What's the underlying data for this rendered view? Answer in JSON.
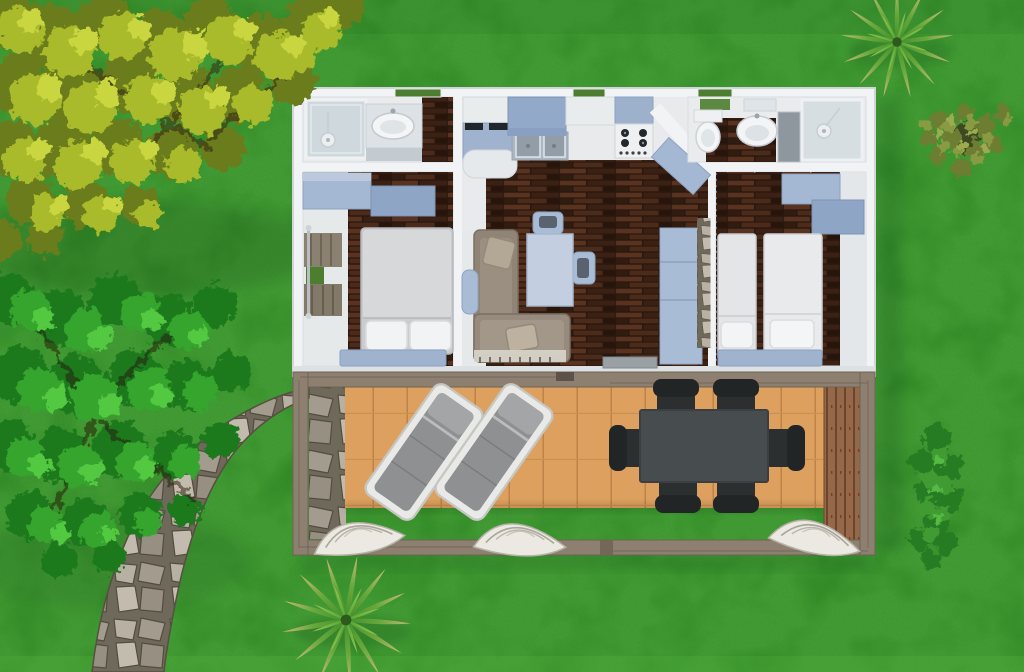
{
  "scene": {
    "description": "Aerial 3D rendering of a two-bedroom holiday mobile home floor plan with furnished interior, a wooden pergola terrace with two sun loungers and a six-seat dining set, set on a lawn with trees, palms, a hedge and a flagstone path",
    "rooms": [
      "left bathroom",
      "master bedroom",
      "kitchen and living room",
      "right bathroom",
      "twin bedroom",
      "terrace"
    ]
  },
  "colors": {
    "grass": "#419a33",
    "grass_edge_light": "#5cb942",
    "tree_yellow_mid": "#a9ba2c",
    "tree_green_mid": "#36a52e",
    "wall": "#f1f3f4",
    "floor_wood": "#2a1810",
    "cabinet_blue": "#a5b8d3",
    "cabinet_blue_deep": "#8fa5c5",
    "counter_blue": "#c3cfe0",
    "hanging_cabinet_blue": "#93a9c9",
    "bed_grey": "#caccce",
    "bed_white": "#e8eaec",
    "pillow_white": "#f2f3f5",
    "sofa_taupe": "#8f8475",
    "deck_wood": "#dda05f",
    "pergola_wood": "#8d8071",
    "screen_wood": "#96684a",
    "table_dark": "#474c4e",
    "chair_black": "#212526",
    "lounge_grey": "#8e9092",
    "drape_white": "#ece9e2",
    "window_green": "#4d7d2f",
    "doormat_grey": "#9aa0a3"
  },
  "objects": {
    "trees": 2,
    "palms": 2,
    "lounge_chairs": 2,
    "dining_chairs": 6,
    "drapes": 3,
    "beds": 3,
    "bathrooms": 2
  }
}
